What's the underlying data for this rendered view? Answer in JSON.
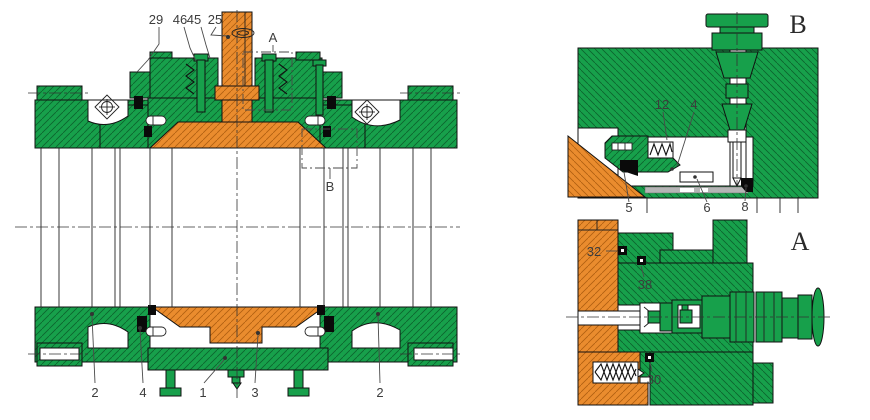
{
  "figure": {
    "kind": "ball-valve-cross-section-drawing",
    "colors": {
      "body_green": "#17a04b",
      "green_hatch": "#0c632d",
      "part_orange": "#ea8c2e",
      "orange_hatch": "#b05f10",
      "seal_black": "#0a0a0a",
      "seat_gray": "#b5b5b5",
      "line": "#1a1a1a",
      "label": "#3d3d3d"
    },
    "main_view": {
      "top_callouts": [
        {
          "label": "29"
        },
        {
          "label": "46"
        },
        {
          "label": "45"
        },
        {
          "label": "25"
        }
      ],
      "bottom_callouts": [
        {
          "label": "2"
        },
        {
          "label": "4"
        },
        {
          "label": "1"
        },
        {
          "label": "3"
        },
        {
          "label": "2"
        }
      ],
      "detail_a_marker": "A",
      "detail_b_marker": "B"
    },
    "detail_b": {
      "title": "B",
      "callout_12": "12",
      "callout_4": "4",
      "callout_5": "5",
      "callout_6": "6",
      "callout_8": "8"
    },
    "detail_a": {
      "title": "A",
      "callout_32": "32",
      "callout_38": "38",
      "callout_30": "30"
    }
  }
}
